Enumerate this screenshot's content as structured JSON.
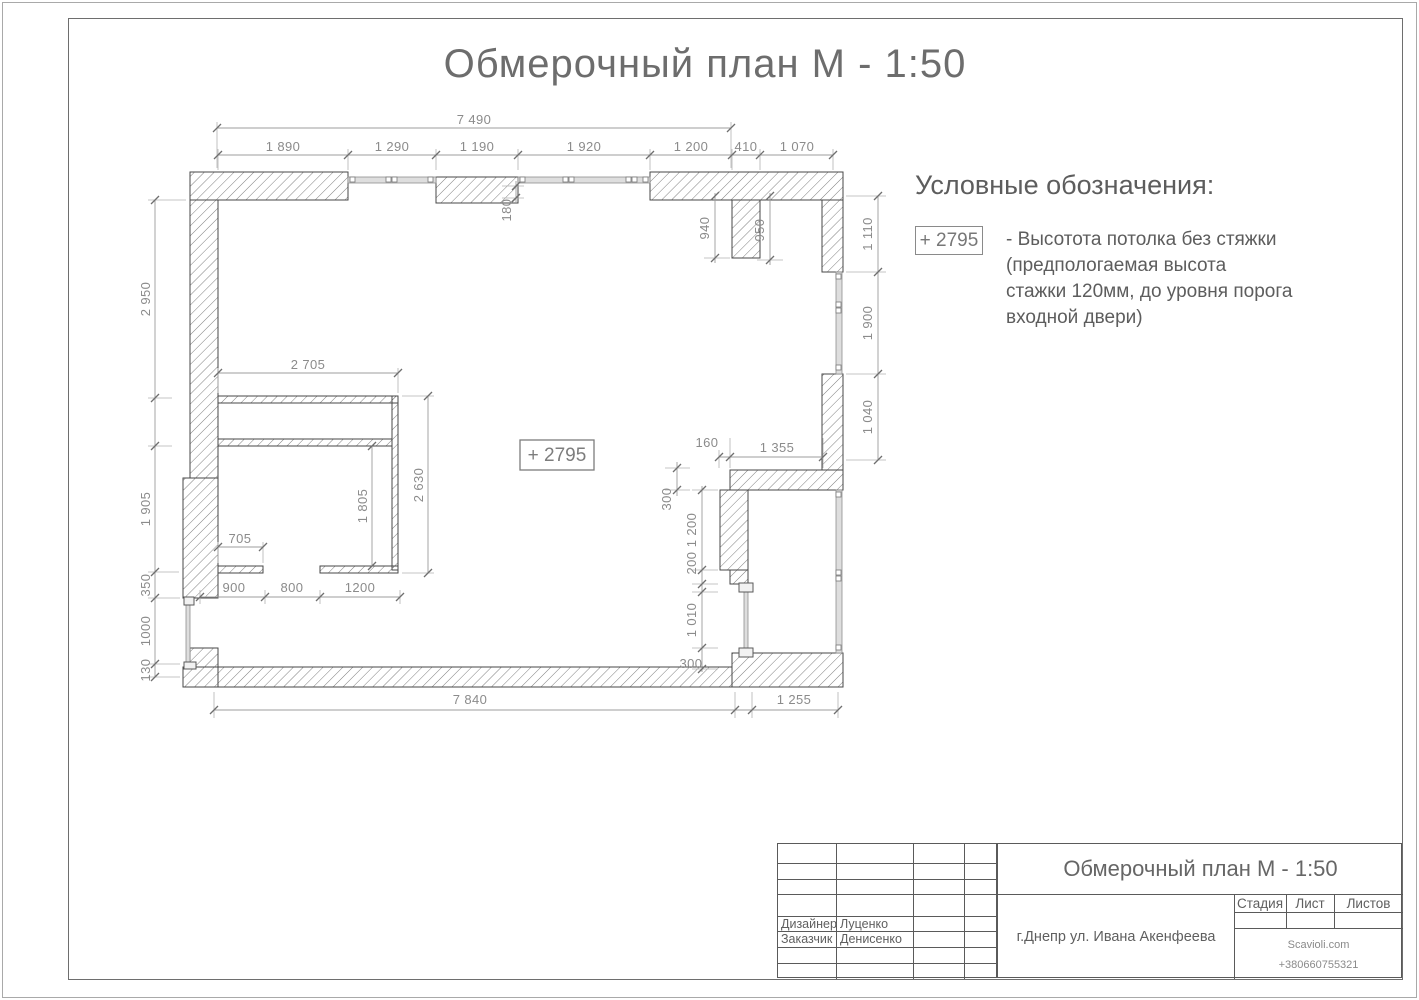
{
  "page": {
    "title": "Обмерочный план М - 1:50"
  },
  "legend": {
    "heading": "Условные обозначения:",
    "height_mark": "+ 2795",
    "desc_line1": "- Высотота потолка без стяжки",
    "desc_line2": "(предпологаемая высота",
    "desc_line3": "стажки 120мм, до уровня порога",
    "desc_line4": "входной двери)"
  },
  "plan": {
    "height_mark": "+ 2795",
    "dims": {
      "top_total": "7 490",
      "top_1": "1 890",
      "top_2": "1 290",
      "top_3": "1 190",
      "top_4": "1 920",
      "top_5": "1 200",
      "top_6": "410",
      "top_7": "1 070",
      "wall_180": "180",
      "niche_left": "940",
      "niche_right": "950",
      "right_1": "1 110",
      "right_2": "1 900",
      "right_3": "1 040",
      "left_1": "2 950",
      "left_2": "1 905",
      "left_3": "350",
      "left_4": "1000",
      "left_5": "130",
      "closet_width": "2 705",
      "closet_height": "2 630",
      "closet_inner": "1 805",
      "closet_shelf": "705",
      "bottom_1": "900",
      "bottom_2": "800",
      "bottom_3": "1200",
      "mid_160": "160",
      "mid_1355": "1 355",
      "mid_300_top": "300",
      "mid_1200": "1 200",
      "mid_200": "200",
      "door_1010": "1 010",
      "mid_300_bottom": "300",
      "bottom_total": "7 840",
      "bottom_balcony": "1 255"
    }
  },
  "title_block": {
    "title": "Обмерочный план М - 1:50",
    "designer_label": "Дизайнер",
    "designer_name": "Луценко",
    "client_label": "Заказчик",
    "client_name": "Денисенко",
    "address": "г.Днепр ул. Ивана Акенфеева",
    "stage_label": "Стадия",
    "sheet_label": "Лист",
    "sheets_label": "Листов",
    "company": "Scavioli.com",
    "phone": "+380660755321"
  }
}
